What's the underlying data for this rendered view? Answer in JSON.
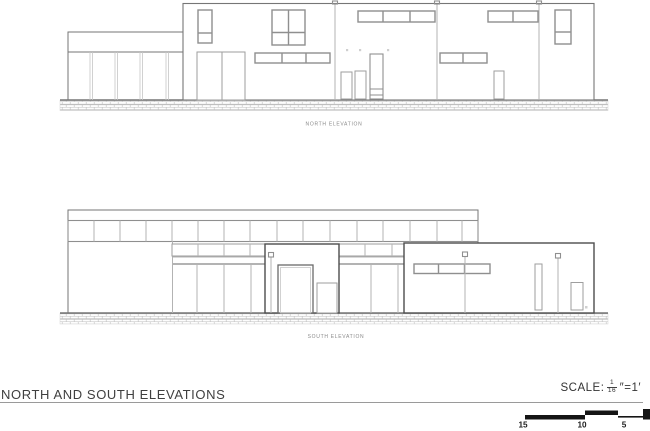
{
  "colors": {
    "outline": "#767676",
    "frame": "#8f8f8f",
    "mullion": "#b3b3b3",
    "foreground_outline": "#4d4d4d",
    "ground_line": "#5a5a5a",
    "label_text": "#8a8a8a",
    "title_text": "#3f3f3f",
    "scale_bar": "#151515"
  },
  "drawings": {
    "north_label": "NORTH ELEVATION",
    "south_label": "SOUTH ELEVATION"
  },
  "title_block": {
    "title": "NORTH AND SOUTH ELEVATIONS",
    "scale_label": "SCALE:",
    "scale_numerator": "1",
    "scale_denominator": "16",
    "scale_units": "″=1′"
  },
  "scale_bar": {
    "labels": [
      "15",
      "10",
      "5"
    ]
  }
}
